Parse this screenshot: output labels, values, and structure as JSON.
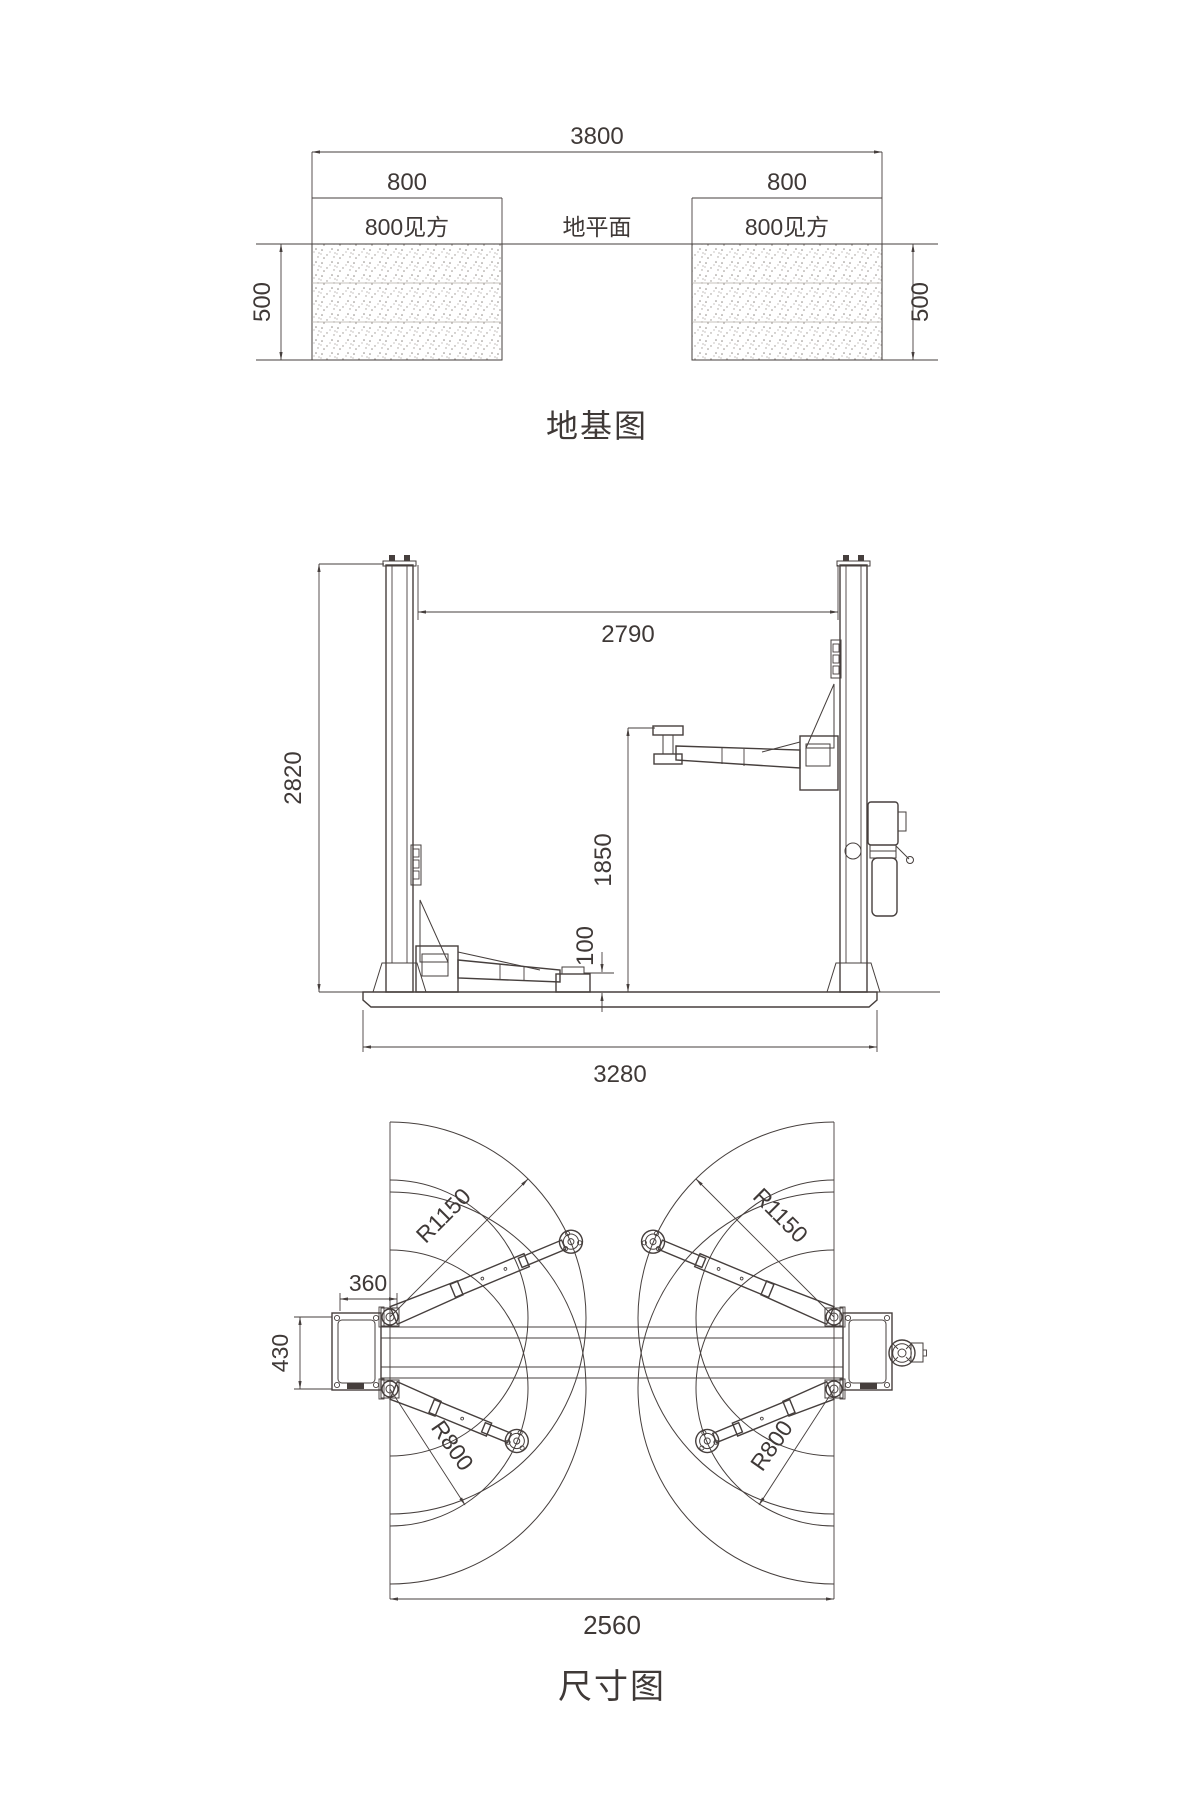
{
  "drawing": {
    "foundation": {
      "title": "地基图",
      "dim_total_width": "3800",
      "dim_pad_left": "800",
      "dim_pad_right": "800",
      "label_block_left": "800见方",
      "label_block_right": "800见方",
      "label_ground_level": "地平面",
      "dim_depth_left": "500",
      "dim_depth_right": "500"
    },
    "side_view": {
      "dim_column_height": "2820",
      "dim_clear_width": "2790",
      "dim_lift_height": "1850",
      "dim_min_pad_height": "100",
      "dim_base_width": "3280"
    },
    "plan_view": {
      "title": "尺寸图",
      "dim_column_depth": "360",
      "dim_column_width": "430",
      "dim_drive_through": "2560",
      "radius_long_arm_left": "R1150",
      "radius_long_arm_right": "R1150",
      "radius_short_arm_left": "R800",
      "radius_short_arm_right": "R800"
    },
    "colors": {
      "line": "#463f3d",
      "text": "#3f3937",
      "background": "#ffffff"
    }
  }
}
